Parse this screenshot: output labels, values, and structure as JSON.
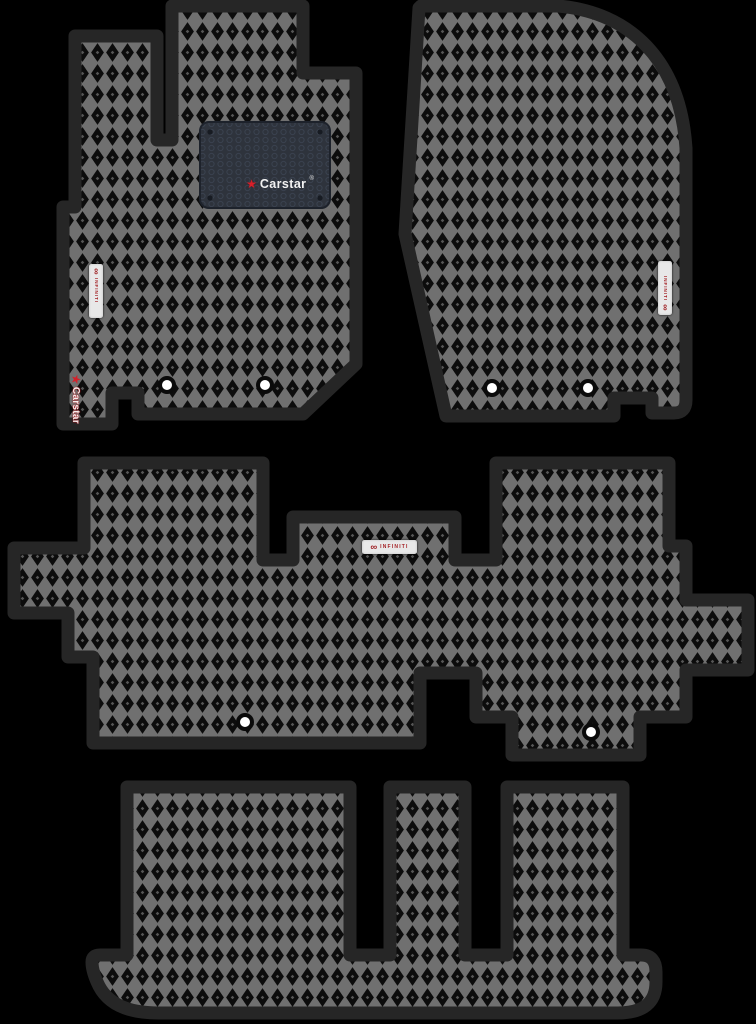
{
  "photo": {
    "background_color": "#000000",
    "brand": {
      "carstar_logo_text": "Carstar",
      "carstar_reg_mark": "®",
      "carstar_corner_text": "Carstar",
      "carstar_star_glyph": "★",
      "infiniti_tag_text": "INFINITI",
      "infiniti_logo_glyph": "∞"
    },
    "colors": {
      "mat_border": "#262626",
      "pattern_line": "#707070",
      "pattern_cell": "#0c0c0c",
      "pattern_dot": "#565656",
      "heel_pad": "#2e333c",
      "tag_background": "#e8e8e8",
      "brand_red": "#c1171d",
      "hole_fill": "#ffffff"
    },
    "mats": [
      {
        "id": "front-left-driver-mat",
        "fastener_holes": 2,
        "labels": [
          "Carstar®",
          "INFINITI",
          "Carstar"
        ]
      },
      {
        "id": "front-right-passenger-mat",
        "fastener_holes": 2,
        "labels": [
          "INFINITI"
        ]
      },
      {
        "id": "second-row-mat",
        "fastener_holes": 2,
        "labels": [
          "INFINITI"
        ]
      },
      {
        "id": "third-row-mat",
        "fastener_holes": 0,
        "labels": []
      }
    ]
  }
}
